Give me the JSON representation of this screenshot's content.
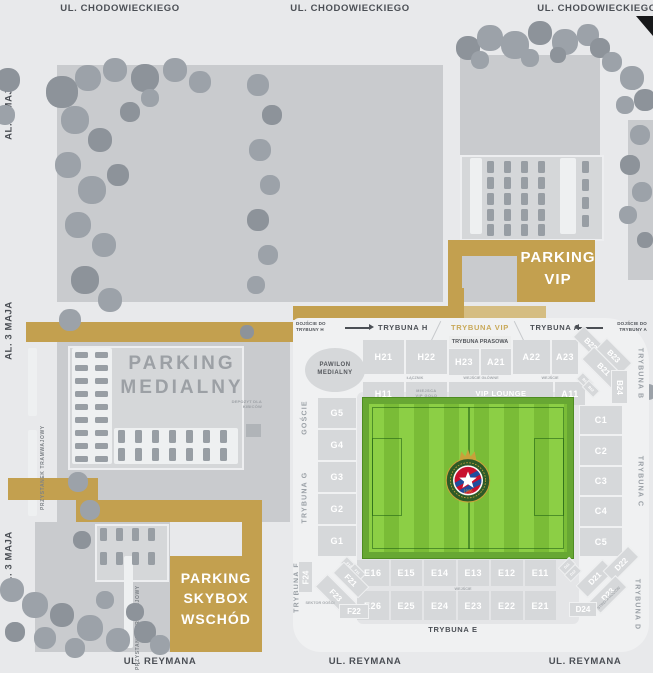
{
  "streets": {
    "chodowieckiego": "UL. CHODOWIECKIEGO",
    "maja": "AL. 3 MAJA",
    "reymana": "UL. REYMANA",
    "tram_stop": "PRZYSTANEK TRAMWAJOWY"
  },
  "parking": {
    "medialny_line1": "PARKING",
    "medialny_line2": "MEDIALNY",
    "vip_line1": "PARKING",
    "vip_line2": "VIP",
    "skybox_line1": "PARKING",
    "skybox_line2": "SKYBOX",
    "skybox_line3": "WSCHÓD",
    "depot": "DEPOZYT DLA KIBICÓW"
  },
  "stadium": {
    "approach_h": "DOJŚCIE DO TRYBUNY H",
    "approach_a": "DOJŚCIE DO TRYBUNY A",
    "stand_h": "TRYBUNA H",
    "stand_vip": "TRYBUNA VIP",
    "stand_a": "TRYBUNA A",
    "stand_b": "TRYBUNA B",
    "stand_c": "TRYBUNA C",
    "stand_d": "TRYBUNA D",
    "stand_e": "TRYBUNA E",
    "stand_f": "TRYBUNA F",
    "stand_g": "TRYBUNA G",
    "press_stand": "TRYBUNA PRASOWA",
    "media_pavilion": "PAWILON MEDIALNY",
    "vip_lounge": "VIP LOUNGE",
    "guests": "GOŚCIE",
    "family_zone": "STREFA RODZIN",
    "away_sector": "SEKTOR GOŚCI",
    "gate_labels": [
      "ŁĄCZNIK",
      "WEJŚCIE GŁÓWNE",
      "WEJŚCIE"
    ],
    "south_gate": "WEJŚCIE",
    "utility_box": "MIEJSCA VIP GOLD",
    "crest_year": "1906",
    "sections": {
      "north_left": [
        "H21",
        "H22"
      ],
      "press_sub": [
        "H23",
        "A21"
      ],
      "north_right": [
        "A22",
        "A23"
      ],
      "north2_left": [
        "H11"
      ],
      "north2_right": [
        "A11"
      ],
      "west": [
        "G5",
        "G4",
        "G3",
        "G2",
        "G1"
      ],
      "east": [
        "C1",
        "C2",
        "C3",
        "C4",
        "C5"
      ],
      "south1": [
        "E16",
        "E15",
        "E14",
        "E13",
        "E12",
        "E11"
      ],
      "south2": [
        "E26",
        "E25",
        "E24",
        "E23",
        "E22",
        "E21"
      ],
      "ne_corner": [
        "B22",
        "B23",
        "B21",
        "B24"
      ],
      "ne_small": [
        "B11",
        "B12"
      ],
      "se_corner": [
        "D21",
        "D22",
        "D23",
        "D24"
      ],
      "se_small": [
        "D11",
        "D12"
      ],
      "sw_corner": [
        "F21",
        "F23",
        "F24",
        "F22"
      ],
      "sw_small": [
        "F12",
        "F11"
      ]
    }
  },
  "colors": {
    "gold": "#c3a04f",
    "gold_light": "#d5bd82",
    "gold_text": "#c9a959",
    "pitch_border": "#67a733",
    "pitch_green_light": "#8ccf45",
    "pitch_green_dark": "#7abc37",
    "crest_red": "#c8102e",
    "crest_blue": "#1f4e9e",
    "crest_green": "#2d5a27",
    "crest_gold": "#c9a13b"
  }
}
